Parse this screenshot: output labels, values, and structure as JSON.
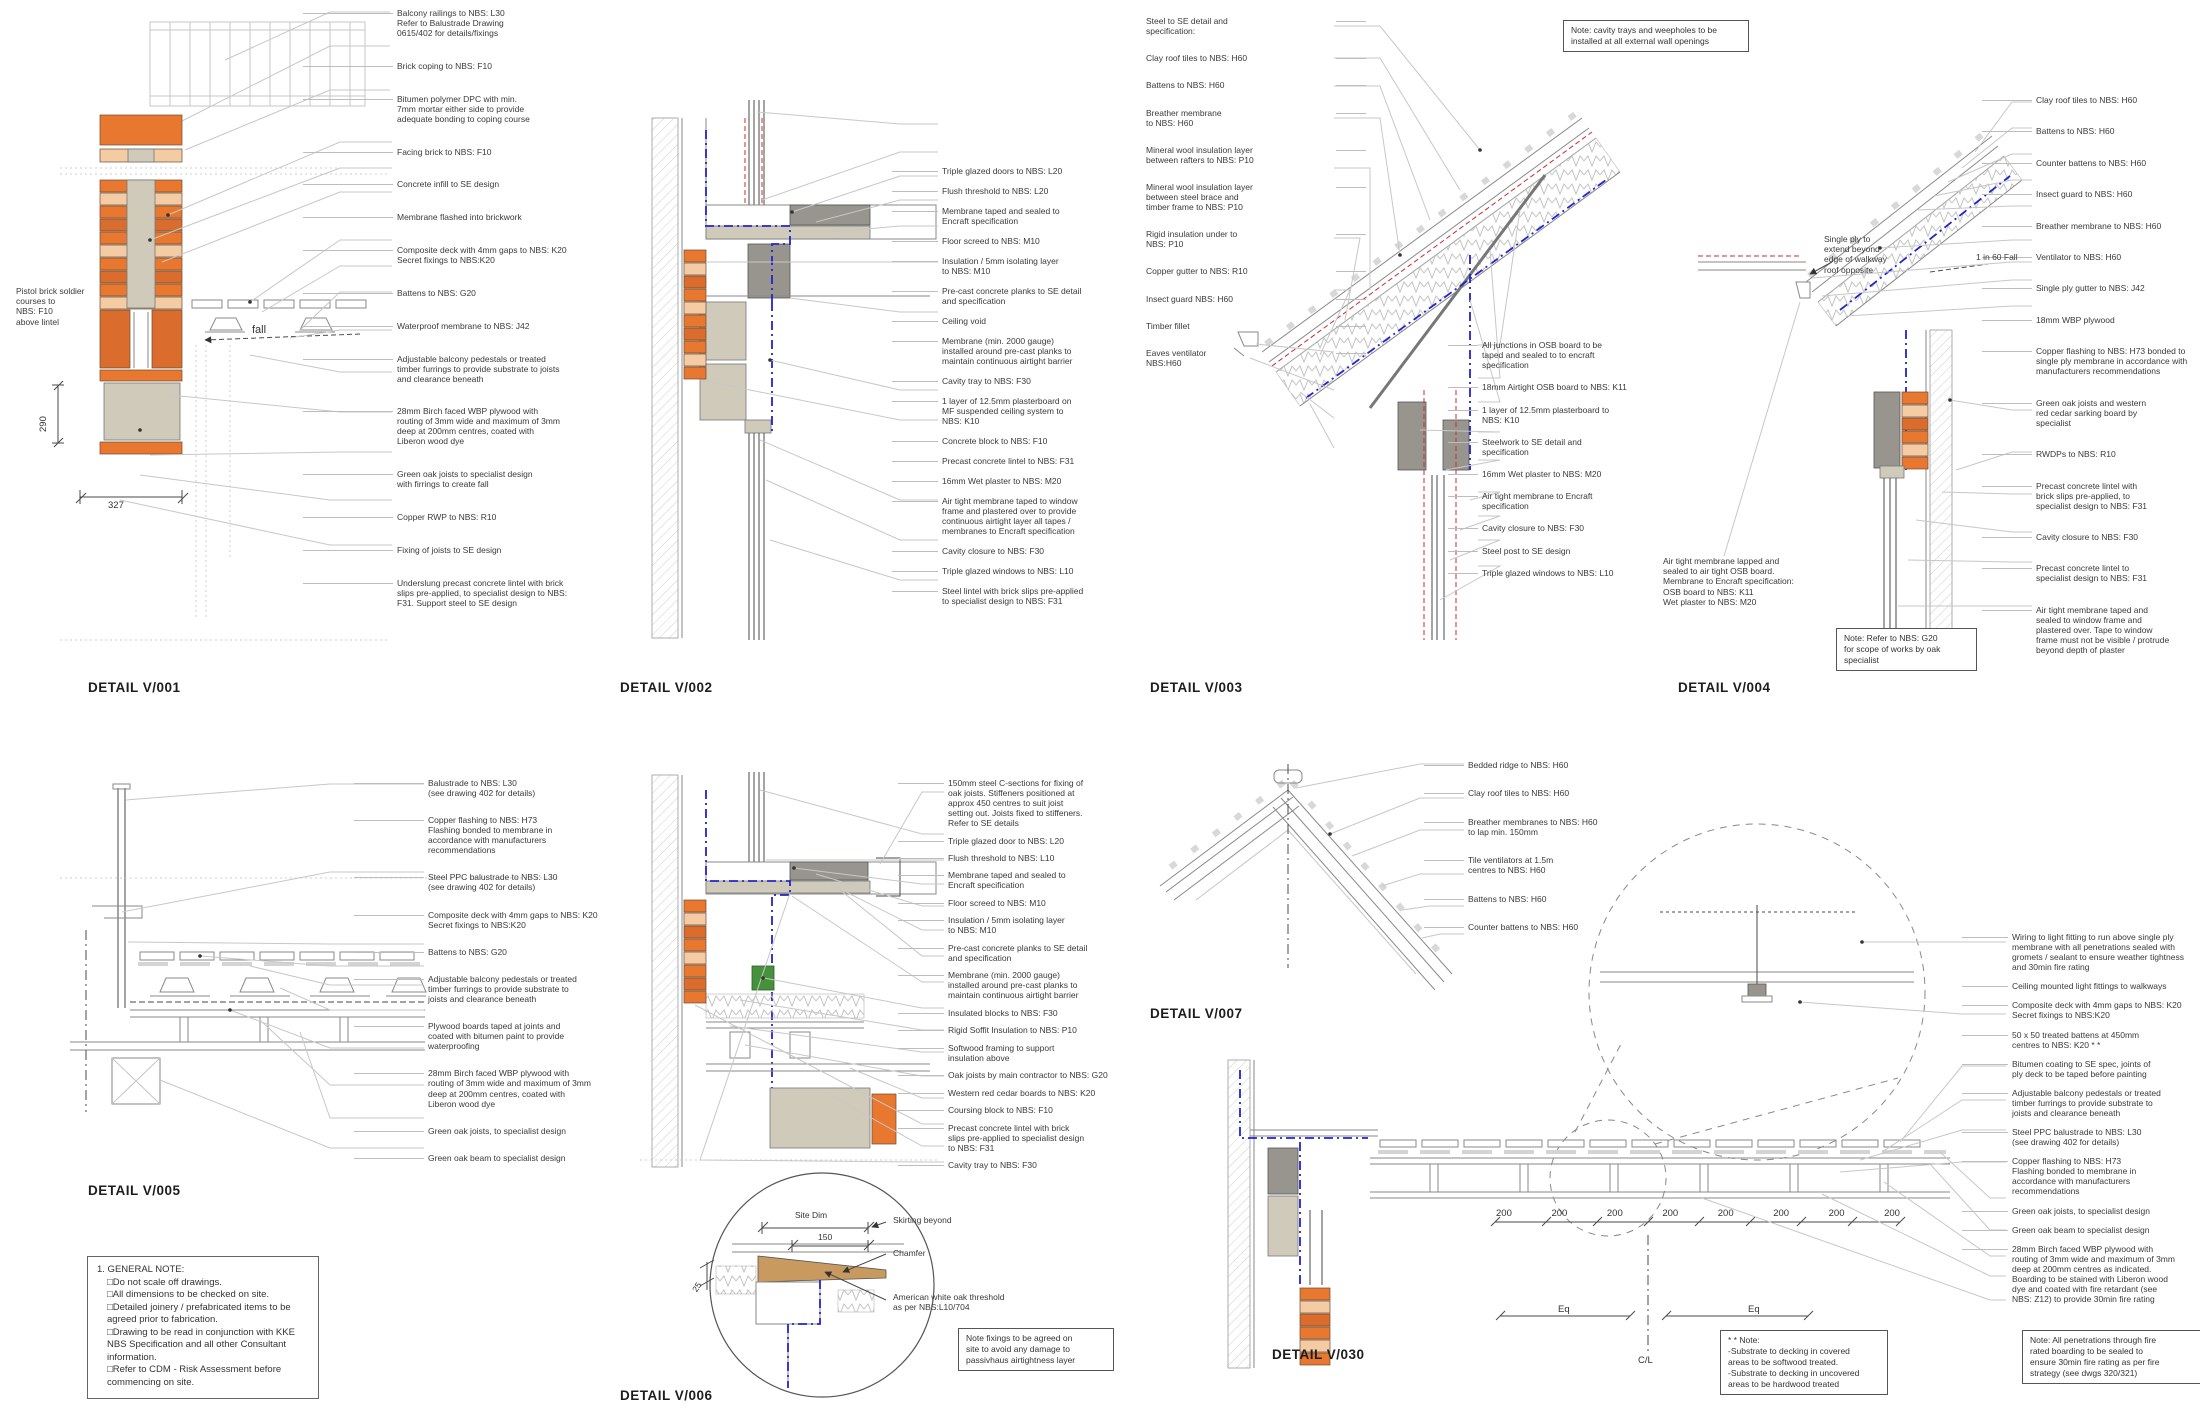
{
  "titles": {
    "v001": "DETAIL V/001",
    "v002": "DETAIL V/002",
    "v003": "DETAIL V/003",
    "v004": "DETAIL V/004",
    "v005": "DETAIL V/005",
    "v006": "DETAIL V/006",
    "v007": "DETAIL V/007",
    "v030": "DETAIL V/030"
  },
  "v001": {
    "labels": [
      "Balcony railings to NBS: L30\nRefer to Balustrade Drawing\n0615/402 for details/fixings",
      "Brick coping to NBS: F10",
      "Bitumen polymer DPC with min.\n7mm mortar either side to provide\nadequate bonding to coping course",
      "Facing brick to NBS: F10",
      "Concrete infill to SE design",
      "Membrane flashed into brickwork",
      "Composite deck with 4mm gaps to NBS: K20\nSecret fixings to NBS:K20",
      "Battens to NBS: G20",
      "Waterproof membrane to NBS: J42",
      "Adjustable balcony pedestals or treated\ntimber furrings to provide substrate to joists\nand clearance beneath",
      "28mm Birch faced WBP plywood with\nrouting of 3mm wide and maximum of 3mm\ndeep at 200mm centres, coated with\nLiberon wood dye",
      "Green oak joists to specialist design\nwith firrings to create fall",
      "Copper RWP to NBS: R10",
      "Fixing of joists to SE design",
      "Underslung precast concrete lintel with brick\nslips pre-applied, to specialist design to NBS:\nF31. Support steel to SE design"
    ],
    "side_label": "Pistol brick soldier\ncourses to\nNBS: F10\nabove lintel",
    "dim_vert": "290",
    "dim_horiz": "327",
    "fall": "fall"
  },
  "v002": {
    "labels": [
      "Triple glazed doors to NBS: L20",
      "Flush threshold to NBS: L20",
      "Membrane taped and sealed to\nEncraft specification",
      "Floor screed to NBS: M10",
      "Insulation / 5mm isolating layer\nto NBS: M10",
      "Pre-cast concrete planks to SE detail\nand specification",
      "Ceiling void",
      "Membrane (min. 2000 gauge)\ninstalled around pre-cast planks to\nmaintain continuous airtight barrier",
      "Cavity tray to NBS: F30",
      "1 layer of 12.5mm plasterboard on\nMF suspended ceiling system to\nNBS: K10",
      "Concrete block to NBS: F10",
      "Precast concrete lintel to NBS: F31",
      "16mm Wet plaster to NBS: M20",
      "Air tight membrane taped to window\nframe and plastered over to provide\ncontinuous airtight layer all tapes /\nmembranes to Encraft specification",
      "Cavity closure to NBS: F30",
      "Triple glazed windows to NBS: L10",
      "Steel lintel with brick slips pre-applied\nto specialist design to NBS: F31"
    ]
  },
  "v003": {
    "labels_left": [
      "Steel to SE detail and\nspecification:",
      "Clay roof tiles to NBS: H60",
      "Battens to NBS: H60",
      "Breather membrane\nto NBS: H60",
      "Mineral wool insulation layer\nbetween rafters to NBS: P10",
      "Mineral wool insulation layer\nbetween steel brace and\ntimber frame to NBS: P10",
      "Rigid insulation under to\nNBS: P10",
      "Copper gutter to NBS: R10",
      "Insect guard NBS: H60",
      "Timber fillet",
      "Eaves ventilator\nNBS:H60"
    ],
    "labels_right": [
      "All junctions in OSB board to be\ntaped and sealed to to encraft\nspecification",
      "18mm Airtight OSB board to NBS: K11",
      "1 layer of 12.5mm plasterboard to\nNBS: K10",
      "Steelwork to SE detail and\nspecification",
      "16mm Wet plaster to NBS: M20",
      "Air tight membrane to Encraft\nspecification",
      "Cavity closure to NBS: F30",
      "Steel post to SE design",
      "Triple glazed windows to NBS: L10"
    ],
    "note": "Note: cavity trays and weepholes to be\ninstalled at all external wall openings"
  },
  "v004": {
    "labels": [
      "Clay roof tiles to NBS: H60",
      "Battens to NBS: H60",
      "Counter battens to NBS: H60",
      "Insect guard to NBS: H60",
      "Breather membrane to NBS: H60",
      "Ventilator to NBS: H60",
      "Single ply gutter to NBS: J42",
      "18mm WBP plywood",
      "Copper flashing to NBS: H73 bonded to\nsingle ply membrane in accordance with\nmanufacturers recommendations",
      "Green oak joists and western\nred cedar sarking board by\nspecialist",
      "RWDPs to NBS: R10",
      "Precast concrete lintel with\nbrick slips pre-applied, to\nspecialist design to NBS: F31",
      "Cavity closure to NBS: F30",
      "Precast concrete lintel to\nspecialist design to NBS: F31",
      "Air tight membrane taped and\nsealed to window frame and\nplastered over. Tape to window\nframe must not be visible / protrude\nbeyond depth of plaster"
    ],
    "single_ply": "Single ply to\nextend beyond\nedge of walkway\nroof opposite",
    "fall": "1 in 60 Fall",
    "airtight": "Air tight membrane lapped and\nsealed to air tight OSB board.\nMembrane to Encraft specification:\nOSB board to NBS: K11\nWet plaster to NBS: M20",
    "note": "Note: Refer to NBS: G20\nfor scope of works by oak\nspecialist"
  },
  "v005": {
    "labels": [
      "Balustrade to NBS: L30\n(see drawing 402 for details)",
      "Copper flashing to NBS: H73\nFlashing bonded to membrane in\naccordance with manufacturers\nrecommendations",
      "Steel PPC balustrade to NBS: L30\n(see drawing 402 for details)",
      "Composite deck with 4mm gaps to NBS: K20\nSecret fixings to NBS:K20",
      "Battens to NBS: G20",
      "Adjustable balcony pedestals or treated\ntimber furrings to provide substrate to\njoists and clearance beneath",
      "Plywood boards taped at joints and\ncoated with bitumen paint to provide\nwaterproofing",
      "28mm Birch faced WBP plywood with\nrouting of 3mm wide and maximum of 3mm\ndeep at 200mm centres, coated with\nLiberon wood dye",
      "Green oak joists, to specialist design",
      "Green oak beam to specialist design"
    ]
  },
  "v006": {
    "labels": [
      "150mm steel C-sections for fixing of\noak joists. Stiffeners positioned at\napprox 450 centres to suit joist\nsetting out.  Joists fixed to stiffeners.\nRefer to SE details",
      "Triple glazed door to NBS: L20",
      "Flush threshold to NBS: L10",
      "Membrane taped and sealed to\nEncraft specification",
      "Floor screed to NBS: M10",
      "Insulation / 5mm isolating layer\nto NBS: M10",
      "Pre-cast concrete planks to SE detail\nand specification",
      "Membrane (min. 2000 gauge)\ninstalled around pre-cast planks to\nmaintain continuous airtight barrier",
      "Insulated blocks to NBS: F30",
      "Rigid Soffit Insulation to NBS: P10",
      "Softwood framing to support\ninsulation above",
      "Oak joists by main contractor to NBS: G20",
      "Western red cedar boards to NBS: K20",
      "Coursing block to NBS: F10",
      "Precast concrete lintel with brick\nslips pre-applied to specialist design\nto NBS: F31",
      "Cavity tray to NBS: F30"
    ],
    "circle_labels": {
      "skirting": "Skirting beyond",
      "chamfer": "Chamfer",
      "threshold": "American white oak threshold\nas per NBS:L10/704"
    },
    "dims": {
      "site_dim": "Site Dim",
      "d150": "150",
      "d25": "25"
    },
    "note": "Note fixings to be agreed on\nsite to avoid any damage to\npassivhaus airtightness layer"
  },
  "v007": {
    "labels": [
      "Bedded ridge to NBS: H60",
      "Clay roof tiles to NBS: H60",
      "Breather membranes to NBS: H60\nto lap min. 150mm",
      "Tile ventilators at 1.5m\ncentres to NBS: H60",
      "Battens to NBS: H60",
      "Counter battens to NBS: H60"
    ]
  },
  "v030": {
    "labels": [
      "Wiring to light fitting to run above single ply\nmembrane with all penetrations sealed with\ngromets / sealant to ensure weather tightness\nand 30min fire rating",
      "Ceiling mounted light fittings to walkways",
      "Composite deck with 4mm gaps to NBS: K20\nSecret fixings to NBS:K20",
      "50 x 50 treated battens at 450mm\ncentres to NBS: K20 * *",
      "Bitumen coating to SE spec, joints of\nply deck to be taped before painting",
      "Adjustable balcony pedestals or treated\ntimber furrings to provide substrate to\njoists and clearance beneath",
      "Steel PPC balustrade to NBS: L30\n(see drawing 402 for details)",
      "Copper flashing to NBS: H73\nFlashing bonded to membrane in\naccordance with manufacturers\nrecommendations",
      "Green oak joists, to specialist design",
      "Green oak beam to specialist design",
      "28mm Birch faced WBP plywood with\nrouting of 3mm wide and maximum of 3mm\ndeep at 200mm centres as indicated.\nBoarding to be stained with Liberon wood\ndye and coated with fire retardant (see\nNBS: Z12) to provide 30min fire rating"
    ],
    "dims_200": [
      "200",
      "200",
      "200",
      "200",
      "200",
      "200",
      "200",
      "200"
    ],
    "eq": "Eq",
    "cl": "C/L",
    "note_star": "* * Note:\n-Substrate to decking in covered\nareas to be softwood treated.\n-Substrate to decking in uncovered\nareas to be hardwood treated",
    "note_fire": "Note: All penetrations through fire\nrated boarding to be sealed to\nensure 30min fire rating as per fire\nstrategy (see dwgs 320/321)"
  },
  "general_note": {
    "title": "1. GENERAL NOTE:",
    "lines": [
      "□Do not scale off drawings.",
      "□All dimensions to be checked on site.",
      "□Detailed joinery / prefabricated items to be agreed prior to fabrication.",
      "□Drawing to be read in conjunction with KKE NBS Specification and all other Consultant information.",
      "□Refer to CDM - Risk Assessment before commencing on site."
    ]
  }
}
